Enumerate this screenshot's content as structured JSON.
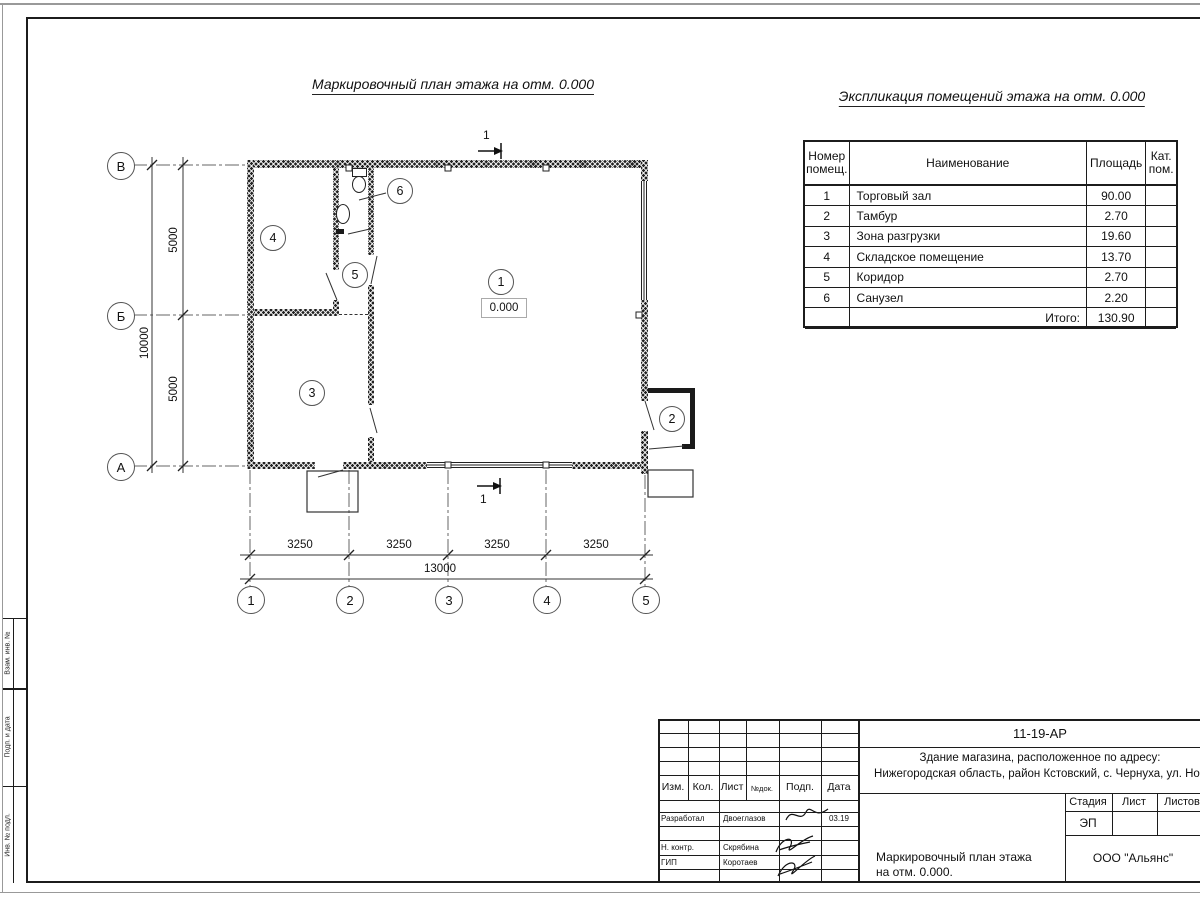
{
  "titles": {
    "plan": "Маркировочный план этажа на отм. 0.000",
    "table": "Экспликация помещений этажа на отм. 0.000"
  },
  "plan": {
    "elevation": "0.000",
    "section_label": "1",
    "room_marks": {
      "r1": "1",
      "r2": "2",
      "r3": "3",
      "r4": "4",
      "r5": "5",
      "r6": "6"
    },
    "row_axes": {
      "v": "В",
      "b": "Б",
      "a": "А"
    },
    "col_axes": {
      "c1": "1",
      "c2": "2",
      "c3": "3",
      "c4": "4",
      "c5": "5"
    },
    "dims": {
      "seg1": "3250",
      "seg2": "3250",
      "seg3": "3250",
      "seg4": "3250",
      "total_h": "13000",
      "seg_v1": "5000",
      "seg_v2": "5000",
      "total_v": "10000"
    }
  },
  "table": {
    "headers": {
      "num": "Номер помещ.",
      "name": "Наименование",
      "area": "Площадь",
      "cat": "Кат. пом."
    },
    "rows": [
      {
        "num": "1",
        "name": "Торговый зал",
        "area": "90.00"
      },
      {
        "num": "2",
        "name": "Тамбур",
        "area": "2.70"
      },
      {
        "num": "3",
        "name": "Зона разгрузки",
        "area": "19.60"
      },
      {
        "num": "4",
        "name": "Складское помещение",
        "area": "13.70"
      },
      {
        "num": "5",
        "name": "Коридор",
        "area": "2.70"
      },
      {
        "num": "6",
        "name": "Санузел",
        "area": "2.20"
      }
    ],
    "total_label": "Итого:",
    "total_value": "130.90"
  },
  "stamp": {
    "doc_number": "11-19-АР",
    "address_line1": "Здание магазина, расположенное по адресу:",
    "address_line2": "Нижегородская область, район Кстовский, с. Чернуха, ул. Нов",
    "cols": {
      "izm": "Изм.",
      "kol": "Кол.",
      "list": "Лист",
      "ndok": "№док.",
      "podp": "Подп.",
      "data": "Дата"
    },
    "roles": [
      {
        "role": "Разработал",
        "name": "Двоеглазов",
        "date": "03.19"
      },
      {
        "role": "Н. контр.",
        "name": "Скрябина",
        "date": ""
      },
      {
        "role": "ГИП",
        "name": "Коротаев",
        "date": ""
      }
    ],
    "stage_label": "Стадия",
    "sheet_label": "Лист",
    "sheets_label": "Листов",
    "stage_value": "ЭП",
    "title_line1": "Маркировочный план этажа",
    "title_line2": "на отм. 0.000.",
    "company": "ООО \"Альянс\""
  },
  "margin_labels": {
    "top": "Взам. инв. №",
    "mid": "Подп. и дата",
    "bottom": "Инв. № подл."
  }
}
